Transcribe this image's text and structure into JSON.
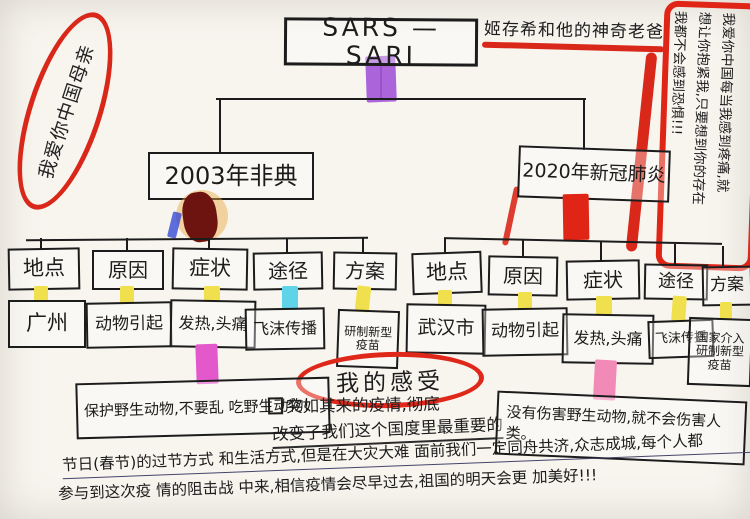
{
  "title": "SARS — SARI",
  "annotations": {
    "top_left_circled": "我爱你中国母亲",
    "top_right_caption": "姬存希和他的神奇老爸",
    "right_note_lines": [
      "我爱你中国每当我感到疼痛,就",
      "想让你抱紧我,只要想到你的存在",
      "我都不会感到恐惧!!!"
    ]
  },
  "branches": [
    {
      "label": "2003年非典",
      "categories": [
        {
          "label": "地点",
          "value": "广州"
        },
        {
          "label": "原因",
          "value": "动物引起"
        },
        {
          "label": "症状",
          "value": "发热,头痛"
        },
        {
          "label": "途径",
          "value": "飞沫传播"
        },
        {
          "label": "方案",
          "value": "研制新型疫苗"
        }
      ]
    },
    {
      "label": "2020年新冠肺炎",
      "categories": [
        {
          "label": "地点",
          "value": "武汉市"
        },
        {
          "label": "原因",
          "value": "动物引起"
        },
        {
          "label": "症状",
          "value": "发热,头痛"
        },
        {
          "label": "途径",
          "value": "飞沫传播"
        },
        {
          "label": "方案",
          "value": "国家介入研制新型疫苗"
        }
      ]
    }
  ],
  "feelings": {
    "heading": "我的感受",
    "note_left": "保护野生动物,不要乱 吃野生动物!",
    "note_middle_line1": "突如其来的疫情,彻底",
    "note_middle_line2": "改变了我们这个国度里最重要的",
    "note_right": "没有伤害野生动物,就不会伤害人类。",
    "paragraph_line1": "节日(春节)的过节方式 和生活方式,但是在大灾大难 面前我们一定同舟共济,众志成城,每个人都",
    "paragraph_line2": "参与到这次疫 情的阻击战 中来,相信疫情会尽早过去,祖国的明天会更 加美好!!!"
  },
  "colors": {
    "red_pen": "#d9281a",
    "purple_highlight": "#a457d8",
    "yellow_highlight": "#f0e04e",
    "cyan_highlight": "#5fd3e8",
    "magenta_highlight": "#e359cc",
    "pink_highlight": "#f28ab8",
    "dark_red_blob": "#6e1410",
    "red_connector": "#e02415",
    "ink": "#1c1c1c"
  }
}
